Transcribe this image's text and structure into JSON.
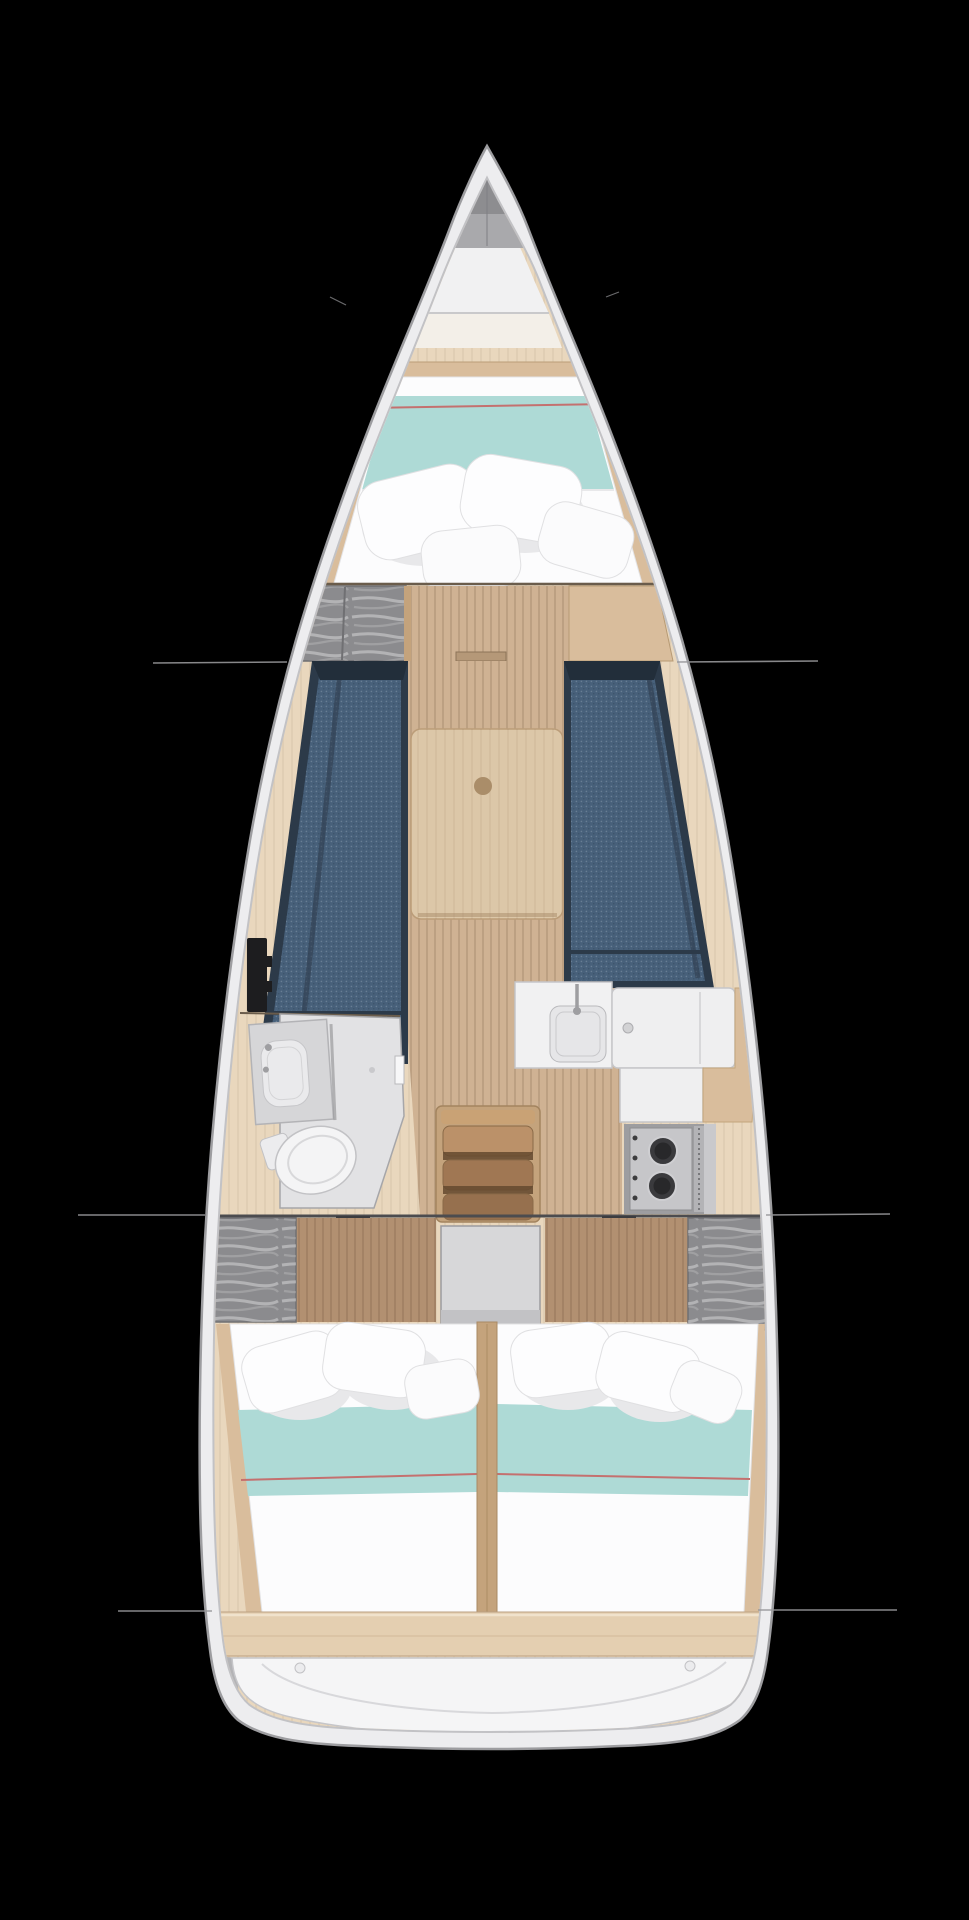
{
  "canvas": {
    "width": 969,
    "height": 1920,
    "background": "#000000"
  },
  "figure": {
    "kind": "sailboat-interior-layout-plan",
    "view": "top-down",
    "bow": "top"
  },
  "palette": {
    "bg": "#000000",
    "hull_rim": "#ededef",
    "hull_stroke": "#9d9da0",
    "hull_inner_shadow": "#c2c2c5",
    "nose_gray": "#8d8d90",
    "deck_gray": "#a9a9ac",
    "deck_white": "#f1f1f2",
    "wood_pale": "#e9d7bd",
    "wood_mid": "#cfb293",
    "wood_tan": "#d9bd9c",
    "wood_frame": "#c4a37c",
    "floor_brown": "#b29071",
    "bulkhead": "#6a5c4b",
    "settee_navy": "#2c3a49",
    "settee_blue": "#47607a",
    "table_wood": "#dcc7a8",
    "table_dot": "#aa8d69",
    "teal": "#aedad6",
    "piping_red": "#c4706f",
    "bedding_white": "#fcfcfd",
    "bedding_shadow": "#e6e6e8",
    "wardrobe_gray": "#8b8b8e",
    "head_floor": "#e2e2e4",
    "head_counter": "#d6d6d8",
    "fixture_white": "#f4f4f5",
    "galley_counter": "#f1f1f2",
    "sink_gray": "#e6e6e8",
    "stove_steel": "#c6c6c9",
    "burner_dark": "#28282a",
    "steps_wood": "#a07753",
    "steps_wood_lt": "#bb9169",
    "steps_shadow": "#64492f",
    "landing_gray": "#d7d7d9",
    "stern_white": "#f5f5f6",
    "panel_black": "#1d1d1f",
    "line_gray": "#97979a"
  },
  "annotations": {
    "leader_lines": [
      {
        "x1": 153,
        "y1": 663,
        "x2": 287,
        "y2": 662
      },
      {
        "x1": 677,
        "y1": 662,
        "x2": 818,
        "y2": 661
      },
      {
        "x1": 78,
        "y1": 1215,
        "x2": 205,
        "y2": 1215
      },
      {
        "x1": 766,
        "y1": 1215,
        "x2": 890,
        "y2": 1214
      },
      {
        "x1": 118,
        "y1": 1611,
        "x2": 212,
        "y2": 1611
      },
      {
        "x1": 758,
        "y1": 1610,
        "x2": 897,
        "y2": 1610
      }
    ],
    "tick_marks": [
      {
        "x1": 330,
        "y1": 297,
        "x2": 346,
        "y2": 305
      },
      {
        "x1": 606,
        "y1": 297,
        "x2": 619,
        "y2": 292
      }
    ]
  },
  "regions": [
    "bow-deck",
    "forward-cabin",
    "saloon",
    "head",
    "galley",
    "companionway",
    "aft-cabin-port",
    "aft-cabin-starboard",
    "stern-platform"
  ]
}
